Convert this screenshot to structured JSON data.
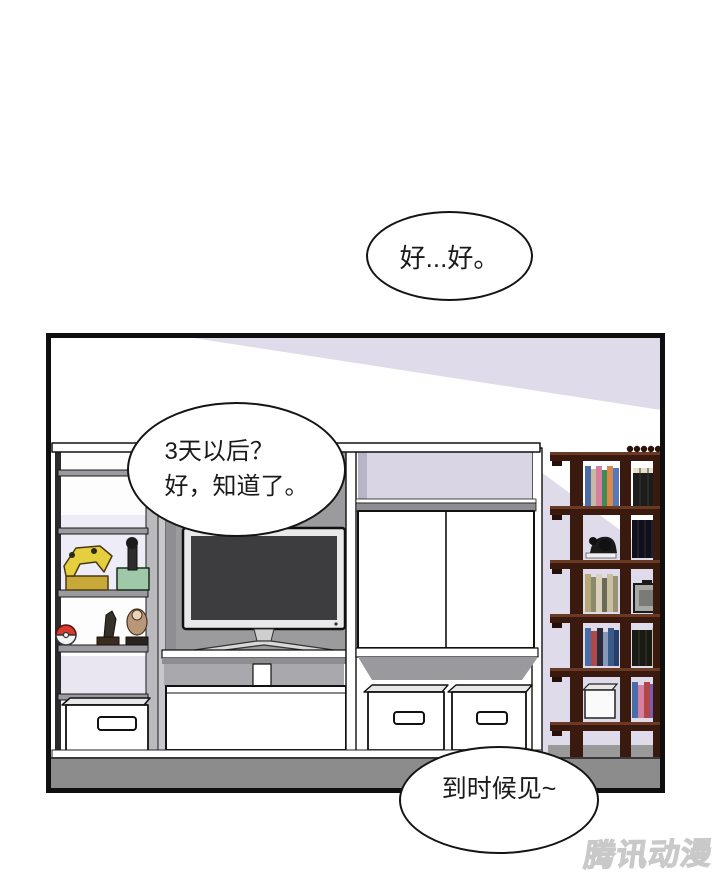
{
  "bubbles": {
    "top": {
      "text": "好...好。"
    },
    "left": {
      "line1": "3天以后？",
      "line2": "好，知道了。"
    },
    "bottom": {
      "text": "到时候见~"
    }
  },
  "watermark": {
    "text": "腾讯动漫"
  },
  "colors": {
    "wall_lavender": "#DFDBEB",
    "panel_border": "#0f0f0f",
    "floor_gray": "#8C8C8C",
    "back_panel_gray": "#9B9B9E",
    "shelf_gray": "#8E8E92",
    "cabinet_white": "#FFFFFF",
    "tv_screen": "#3D3D40",
    "tv_frame": "#E9E9E9",
    "bookshelf_brown": "#3A190E",
    "bookshelf_highlight": "#6B3A24",
    "pokeball_red": "#D63B30",
    "controller_yellow": "#E5CF3E",
    "joystick_base_green": "#9EC8A8"
  }
}
